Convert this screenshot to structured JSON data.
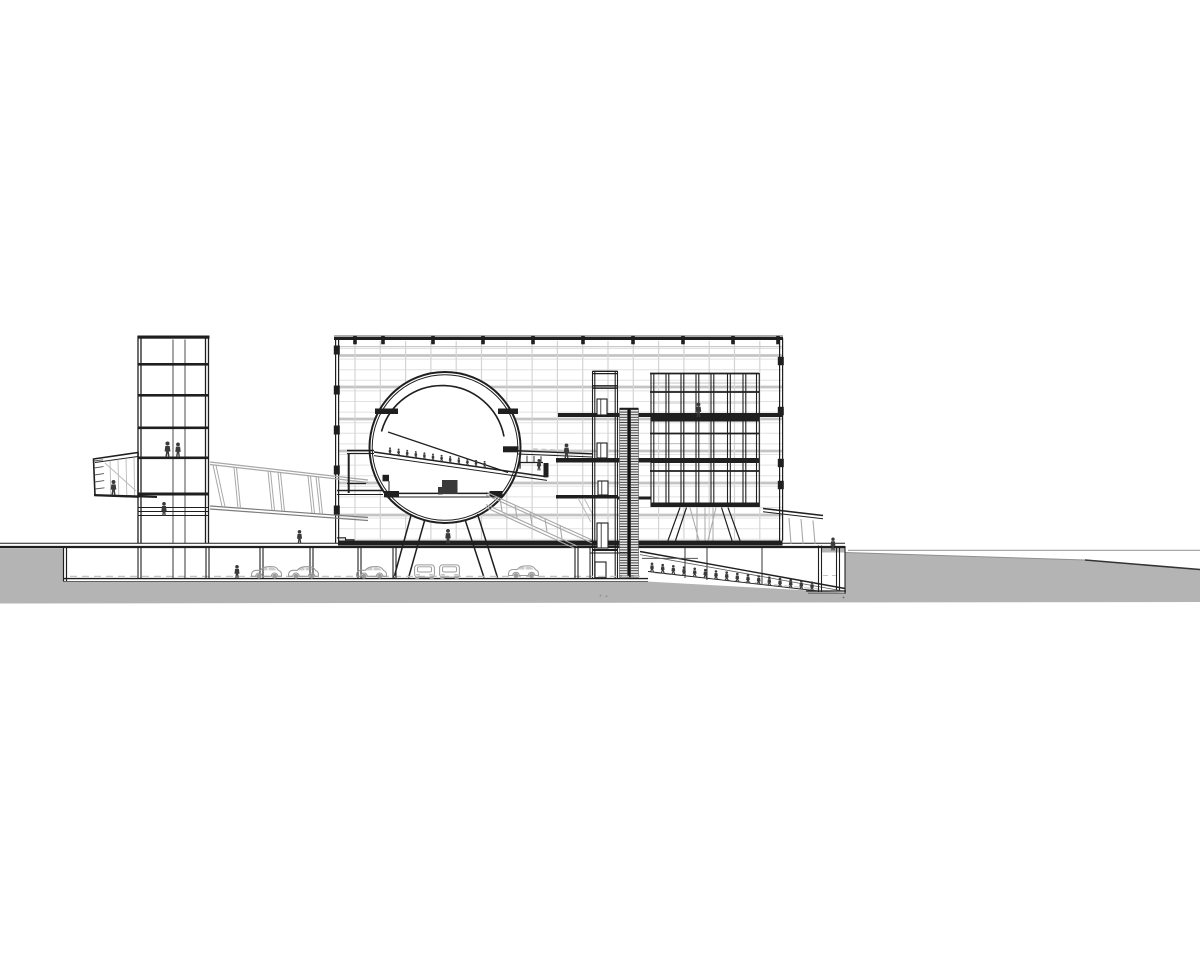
{
  "palette": {
    "ink": "#1f1f1f",
    "soft": "#555555",
    "figure": "#3a3a3a",
    "terrain": "#b4b4b4",
    "grid_v": "#d4d4d4",
    "grid_h": "#e0e0e0",
    "grid_band": "#c4c4c4",
    "truss": "#a8a8a8",
    "truss_dark": "#7c7c7c",
    "car": "#9a9a9a",
    "dash": "#c6c6c6"
  },
  "scene": {
    "curtain_wall": {
      "x1": 339,
      "x2": 782,
      "y1": 341,
      "y2": 539.5,
      "v_start": 355,
      "v_step": 25.3,
      "v_count": 17,
      "h_start": 348.5,
      "h_step": 10.6,
      "h_count": 19,
      "band_ys": [
        355.5,
        387,
        419,
        451,
        483,
        515
      ]
    },
    "roof_tick_xs": [
      355,
      383,
      433,
      483,
      533,
      583,
      633,
      683,
      733,
      778
    ],
    "left_wall_tick_ys": [
      350,
      390,
      430,
      470,
      510
    ],
    "right_wall_tick_ys": [
      361,
      411,
      463,
      485
    ],
    "tower": {
      "x": 137.5,
      "w": 71,
      "top": 335.5,
      "bottom": 543.5,
      "floor_ys": [
        363,
        394,
        426.5,
        456.5
      ],
      "thick_floor_y": 492.5,
      "thin_line_ys": [
        507.5,
        511.5,
        515.5
      ],
      "rail_xs": [
        173,
        185
      ]
    },
    "exhibit_structure": {
      "x1": 650,
      "x2": 759,
      "top": 373,
      "bottom": 507,
      "col_xs": [
        651,
        666,
        681,
        696,
        711,
        727.5,
        743,
        756.5
      ],
      "line_ys": [
        373.5,
        392,
        433.5,
        471
      ],
      "slab_ys": [
        417,
        458.5,
        502.5
      ],
      "gray_ys": [
        383,
        403,
        443.5,
        482.5
      ]
    },
    "elevator": {
      "x1": 592.5,
      "x2": 617.5,
      "top": 371,
      "bottom": 578,
      "cap_ys": [
        371.3,
        373.6,
        385.8,
        388.2
      ],
      "floor_ys": [
        414.5,
        458.5,
        496,
        549
      ],
      "cars": [
        [
          597,
          399,
          10,
          16
        ],
        [
          597,
          443,
          10,
          15
        ],
        [
          598,
          481,
          10,
          14
        ],
        [
          597,
          523,
          11,
          25
        ]
      ]
    },
    "underground": {
      "col_pairs": [
        [
          138,
          548,
          578
        ],
        [
          206,
          548,
          578
        ],
        [
          260,
          548,
          578
        ],
        [
          310,
          548,
          578
        ],
        [
          358,
          548,
          578
        ],
        [
          393,
          548,
          578
        ],
        [
          575,
          548,
          578
        ]
      ],
      "col_singles": [
        [
          173,
          548,
          578
        ],
        [
          185,
          548,
          578
        ],
        [
          685,
          547,
          578
        ],
        [
          707,
          547,
          580
        ],
        [
          762,
          547,
          584
        ]
      ]
    },
    "people_standing": [
      [
        167.5,
        457,
        15.5
      ],
      [
        178,
        457,
        14.5
      ],
      [
        113.5,
        495,
        15
      ],
      [
        164,
        516,
        14
      ],
      [
        299.5,
        543.5,
        13.5
      ],
      [
        448,
        543.5,
        14.5
      ],
      [
        237,
        578.5,
        13.5
      ],
      [
        566.5,
        458,
        14.5
      ],
      [
        539,
        470.5,
        11.5
      ],
      [
        698.5,
        417,
        14.5
      ],
      [
        833,
        550.5,
        13
      ]
    ],
    "sphere_ramp_walkers": [
      [
        390,
        454.3
      ],
      [
        398.6,
        455.5
      ],
      [
        407.2,
        456.8
      ],
      [
        415.8,
        458
      ],
      [
        424.4,
        459.2
      ],
      [
        433,
        460.5
      ],
      [
        441.6,
        461.7
      ],
      [
        450.2,
        463
      ],
      [
        458.8,
        464.2
      ],
      [
        467.4,
        465.4
      ],
      [
        476,
        466.7
      ],
      [
        484.6,
        467.9
      ]
    ],
    "garage_ramp_walkers": [
      [
        652,
        572
      ],
      [
        662.7,
        573.2
      ],
      [
        673.3,
        574.5
      ],
      [
        684,
        575.8
      ],
      [
        694.7,
        577
      ],
      [
        705.3,
        578.3
      ],
      [
        716,
        579.6
      ],
      [
        726.7,
        580.8
      ],
      [
        737.3,
        582.1
      ],
      [
        748,
        583.4
      ],
      [
        758.7,
        584.6
      ],
      [
        769.3,
        585.9
      ],
      [
        780,
        587.1
      ],
      [
        790.7,
        588.4
      ],
      [
        801.3,
        589.7
      ],
      [
        812,
        590.9
      ]
    ],
    "cars_side": [
      [
        250,
        579
      ],
      [
        287,
        579
      ],
      [
        355,
        579
      ],
      [
        507,
        578.2
      ]
    ],
    "cars_rear": [
      [
        413,
        579.5
      ],
      [
        438,
        579.5
      ]
    ]
  }
}
